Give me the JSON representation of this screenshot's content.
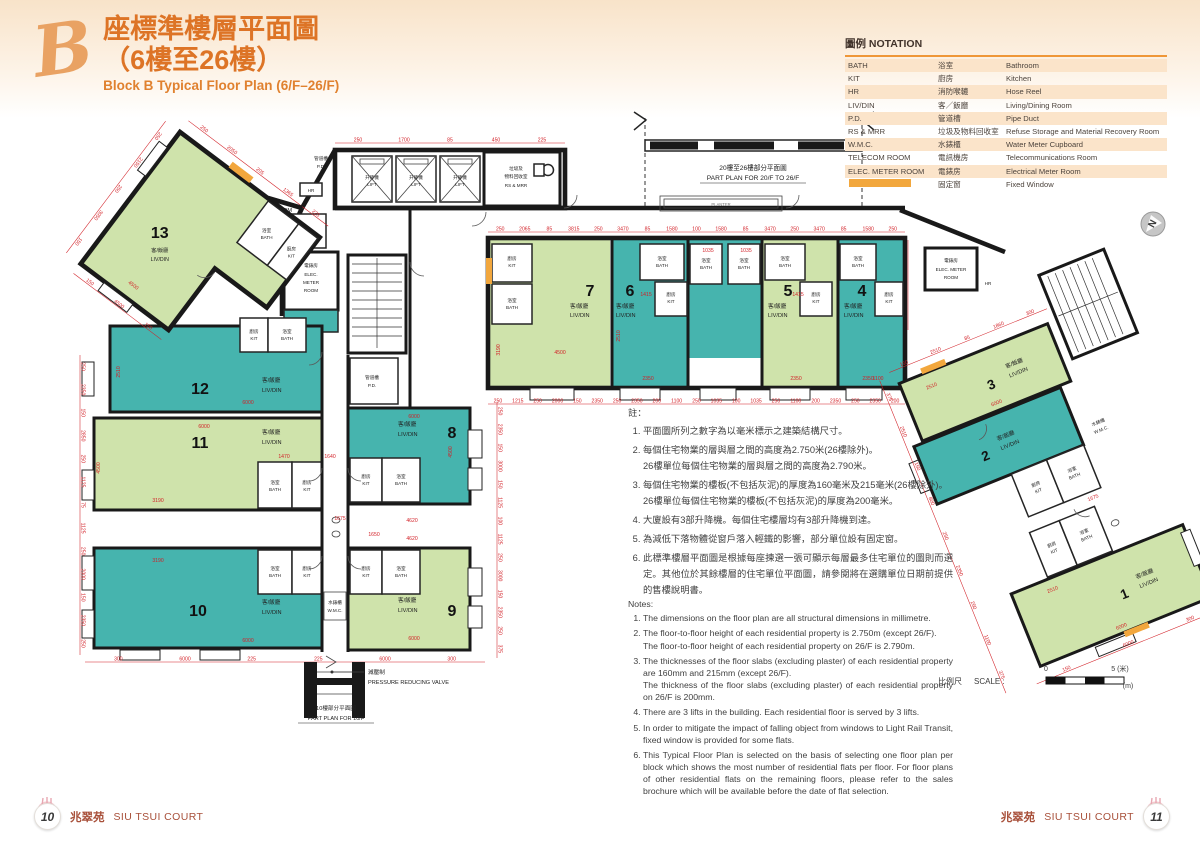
{
  "page": {
    "bg_top": "#f8e3c9"
  },
  "title": {
    "script_letter": "B",
    "zh_line1": "座標準樓層平面圖",
    "zh_line2": "（6樓至26樓）",
    "en": "Block B Typical Floor Plan (6/F–26/F)"
  },
  "north": {
    "label": "N"
  },
  "notation": {
    "header": "圖例 NOTATION",
    "rows": [
      {
        "abbr": "BATH",
        "zh": "浴室",
        "en": "Bathroom"
      },
      {
        "abbr": "KIT",
        "zh": "廚房",
        "en": "Kitchen"
      },
      {
        "abbr": "HR",
        "zh": "消防喉轆",
        "en": "Hose Reel"
      },
      {
        "abbr": "LIV/DIN",
        "zh": "客／飯廳",
        "en": "Living/Dining Room"
      },
      {
        "abbr": "P.D.",
        "zh": "管道槽",
        "en": "Pipe Duct"
      },
      {
        "abbr": "RS & MRR",
        "zh": "垃圾及物料回收室",
        "en": "Refuse Storage and Material Recovery Room"
      },
      {
        "abbr": "W.M.C.",
        "zh": "水錶櫃",
        "en": "Water Meter Cupboard"
      },
      {
        "abbr": "TELECOM ROOM",
        "zh": "電訊機房",
        "en": "Telecommunications Room"
      },
      {
        "abbr": "ELEC. METER ROOM",
        "zh": "電錶房",
        "en": "Electrical Meter Room"
      },
      {
        "abbr": "",
        "zh": "固定窗",
        "en": "Fixed Window"
      }
    ]
  },
  "plan": {
    "unit_label_zh": "客/飯廳",
    "unit_label_en": "LIV/DIN",
    "units": [
      {
        "no": "1"
      },
      {
        "no": "2"
      },
      {
        "no": "3"
      },
      {
        "no": "4"
      },
      {
        "no": "5"
      },
      {
        "no": "6"
      },
      {
        "no": "7"
      },
      {
        "no": "8"
      },
      {
        "no": "9"
      },
      {
        "no": "10"
      },
      {
        "no": "11"
      },
      {
        "no": "12"
      },
      {
        "no": "13"
      }
    ],
    "rooms": {
      "kit_zh": "廚房",
      "kit_en": "KIT",
      "bath_zh": "浴室",
      "bath_en": "BATH"
    },
    "facilities": {
      "lift_zh": "升降機",
      "lift_en": "LIFT",
      "pd_zh": "管道槽",
      "pd_en": "P.D.",
      "hr": "HR",
      "rs_zh1": "垃圾及",
      "rs_zh2": "物料回收室",
      "rs_en": "RS & MRR",
      "telecom_zh": "電訊機房",
      "telecom_en": "TELECOM ROOM",
      "elec_zh": "電錶房",
      "elec_en1": "ELEC.",
      "elec_en2": "METER",
      "elec_en3": "ROOM",
      "elec_en_wide": "ELEC. METER",
      "wmc_zh": "水錶櫃",
      "wmc_en": "W.M.C.",
      "planter": "PLANTER"
    },
    "part_plans": {
      "p2026_zh": "20樓至26樓部分平面圖",
      "p2026_en": "PART PLAN FOR 20/F TO 26/F",
      "p10_zh": "10樓部分平面圖",
      "p10_en": "PART PLAN FOR 10/F",
      "prv_zh": "減壓制",
      "prv_en": "PRESSURE REDUCING VALVE"
    },
    "dims": {
      "top_main": [
        "250",
        "2065",
        "85",
        "3815",
        "250",
        "3470",
        "85",
        "1580",
        "100",
        "1580",
        "85",
        "3470",
        "250",
        "3470",
        "85",
        "1580",
        "250"
      ],
      "bottom_main": [
        "250",
        "1215",
        "250",
        "2000",
        "150",
        "2350",
        "250",
        "2350",
        "200",
        "1100",
        "250",
        "1035",
        "100",
        "1035",
        "250",
        "1100",
        "200",
        "2350",
        "250",
        "2350",
        "200"
      ],
      "left_left": [
        "250",
        "2350",
        "150",
        "2850",
        "250",
        "1125",
        "75",
        "1125",
        "250",
        "2000",
        "150",
        "2350",
        "250"
      ],
      "bottom_left": [
        "300",
        "6000",
        "225",
        "225",
        "6000",
        "300"
      ],
      "right_mid": [
        "250",
        "2350",
        "150",
        "3000",
        "150",
        "1125",
        "100",
        "1125",
        "250",
        "3000",
        "150",
        "2350",
        "250",
        "375"
      ],
      "lobby_top": [
        "250",
        "1700",
        "85",
        "450",
        "225"
      ],
      "wing_left": [
        "375",
        "2510",
        "150",
        "800",
        "250",
        "2350",
        "250",
        "1100",
        "375"
      ],
      "wing_top": [
        "150",
        "2510",
        "85",
        "1860",
        "300"
      ],
      "wing_bottom": [
        "150",
        "6000",
        "300"
      ],
      "u13_left": [
        "250",
        "2150",
        "250",
        "3050",
        "150"
      ],
      "u13_bottom": [
        "150",
        "4500",
        "150"
      ],
      "u13_top": [
        "250",
        "2050",
        "205",
        "1365",
        "225"
      ],
      "singles": [
        "6000",
        "2510",
        "6000",
        "4500",
        "3190",
        "1470",
        "1640",
        "6000",
        "3190",
        "6000",
        "4500",
        "4620",
        "1650",
        "6000",
        "4500",
        "3190",
        "2350",
        "2350",
        "2350",
        "1415",
        "1415",
        "2510",
        "1035",
        "1035",
        "1100",
        "1675",
        "4620"
      ],
      "wing_singles": [
        "6000",
        "2510",
        "6000",
        "1675",
        "2510"
      ],
      "u13_singles": [
        "4500"
      ]
    }
  },
  "notes_zh": {
    "header": "註：",
    "items": [
      "平面圖所列之數字為以毫米標示之建築結構尺寸。",
      "每個住宅物業的層與層之間的高度為2.750米(26樓除外)。\n26樓單位每個住宅物業的層與層之間的高度為2.790米。",
      "每個住宅物業的樓板(不包括灰泥)的厚度為160毫米及215毫米(26樓除外)。\n26樓單位每個住宅物業的樓板(不包括灰泥)的厚度為200毫米。",
      "大廈設有3部升降機。每個住宅樓層均有3部升降機到達。",
      "為減低下落物體從窗戶落入輕鐵的影響，部分單位設有固定窗。",
      "此標準樓層平面圖是根據每座揀選一張可顯示每層最多住宅單位的圖則而選定。其他位於其餘樓層的住宅單位平面圖，請參閱將在選購單位日期前提供的售樓說明書。"
    ]
  },
  "notes_en": {
    "header": "Notes:",
    "items": [
      "The dimensions on the floor plan are all structural dimensions in millimetre.",
      "The floor-to-floor height of each residential property is 2.750m (except 26/F).\nThe floor-to-floor height of each residential property on 26/F is 2.790m.",
      "The thicknesses of the floor slabs (excluding plaster) of each residential property are 160mm and 215mm (except 26/F).\nThe thickness of the floor slabs (excluding plaster) of each residential property on 26/F is 200mm.",
      "There are 3 lifts in the building. Each residential floor is served by 3 lifts.",
      "In order to mitigate the impact of falling object from windows to Light Rail Transit, fixed window is provided for some flats.",
      "This Typical Floor Plan is selected on the basis of selecting one floor plan per block which shows the most number of residential flats per floor. For floor plans of other residential flats on the remaining floors, please refer to the sales brochure which will be available before the date of flat selection."
    ]
  },
  "scale": {
    "label_zh": "比例尺",
    "label_en": "SCALE :",
    "start": "0",
    "end": "5 (米)",
    "unit": "(m)"
  },
  "footer": {
    "name_zh": "兆翠苑",
    "name_en": "SIU TSUI COURT",
    "page_left": "10",
    "page_right": "11"
  },
  "colors": {
    "green": "#cfe3ab",
    "teal": "#46b4ae",
    "dim": "#d21f26",
    "wall": "#191919",
    "accent": "#e2752b",
    "swatch": "#f2a73d",
    "row": "#fbe4ca",
    "footer": "#a8503a"
  }
}
